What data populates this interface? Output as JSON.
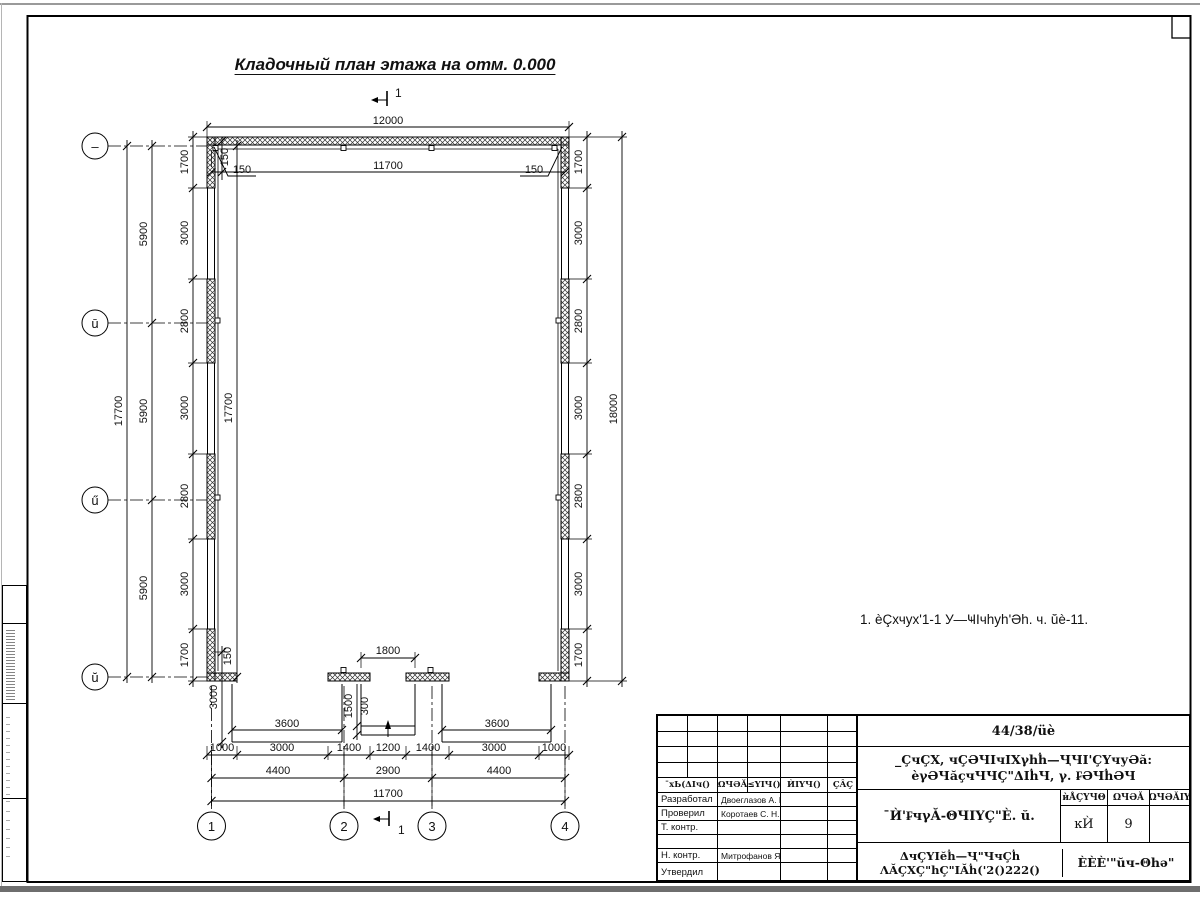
{
  "drawing": {
    "title": "Кладочный план этажа на отм. 0.000",
    "note": "1. èÇхчух'1-1 У—ҸIчhуh'Әh. ч. ŭè-11.",
    "section_label": "1",
    "axes": {
      "rows": [
        "–",
        "ū",
        "ű",
        "ŭ"
      ],
      "cols": [
        "1",
        "2",
        "3",
        "4"
      ]
    },
    "dims": {
      "top_total": "12000",
      "top_inner": "11700",
      "off150": "150",
      "left_total": "17700",
      "left_inner_total": "17700",
      "left_spacing": [
        "5900",
        "5900",
        "5900"
      ],
      "side_chain": [
        "1700",
        "3000",
        "2800",
        "3000",
        "2800",
        "3000",
        "1700"
      ],
      "right_total": "18000",
      "door": "1800",
      "step1": "1500",
      "step2": "300",
      "porch_width": "3600",
      "porch_depth": "3000",
      "bottom_chain": [
        "1000",
        "3000",
        "1400",
        "1200",
        "1400",
        "3000",
        "1000"
      ],
      "bottom_axes": [
        "4400",
        "2900",
        "4400"
      ],
      "bottom_total": "11700"
    }
  },
  "title_block": {
    "doc_number": "44/38/üè",
    "project_line1": "_ÇчÇX, чÇӘЧIчIXγhḣ—ҶЧI'ÇҮчуӘă:",
    "project_line2": "èγӘЧăçчЧЧÇ\"ΔIḣЧ, γ. ₣ӘЧḣӘЧ",
    "object_name": "¯Ѝ'₣чγĂ-ΘЧIҮÇ\"È. ŭ.",
    "header_cols": [
      "¯хЬ(ΔIч()",
      "ΩЧӘĂ",
      "≤ҮIЧ()",
      "ЍIҮЧ()",
      "ÇÂÇ"
    ],
    "rows": [
      {
        "label": "Разработал",
        "name": "Двоеглазов А. В."
      },
      {
        "label": "Проверил",
        "name": "Коротаев С. Н."
      },
      {
        "label": "Т. контр.",
        "name": ""
      },
      {
        "label": "",
        "name": ""
      },
      {
        "label": "Н. контр.",
        "name": "Митрофанов Я. А."
      },
      {
        "label": "Утвердил",
        "name": ""
      }
    ],
    "stage_headers": [
      "ѝÅÇҮЧΘ",
      "ΩЧӘĂ",
      "ΩЧӘĂIҮ"
    ],
    "stage_values": [
      "ĸЍ",
      "9",
      ""
    ],
    "doc_line1": "ΔчÇҮIĕḣ—Ҷ\"ЧчÇḣ",
    "doc_line2": "ΛĂÇХÇ\"hÇ\"IĂḣ('2()222()",
    "company": "ÈÈÈ'\"ŭч-Θhә\""
  }
}
